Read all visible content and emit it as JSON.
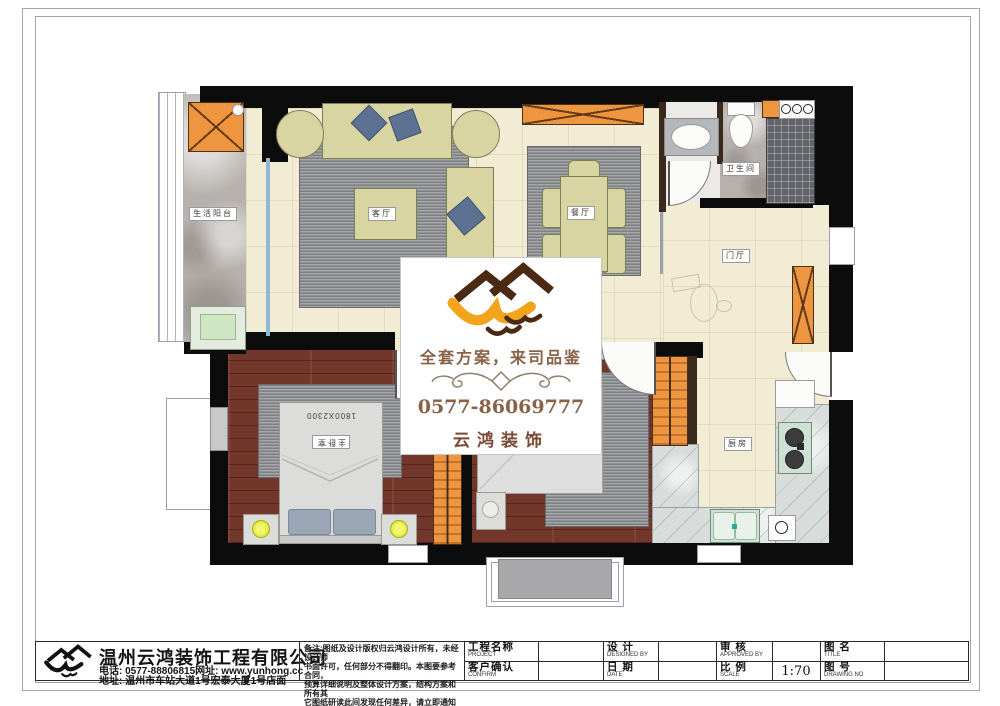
{
  "plan": {
    "labels": {
      "balcony": "生活阳台",
      "living": "客厅",
      "dining": "餐厅",
      "bathroom": "卫生间",
      "hall": "门厅",
      "master": "主卧室",
      "master_bed_size": "1800X2300",
      "kitchen": "厨房"
    }
  },
  "watermark": {
    "slogan": "全套方案，来司品鉴",
    "phone": "0577-86069777",
    "brand": "云鸿装饰"
  },
  "titleblock": {
    "company": "温州云鸿装饰工程有限公司",
    "phone_line": "电话: 0577-88806815网址: www.yunhong.cc",
    "address_line": "地址: 温州市车站大道1号宏泰大厦1号店面",
    "notes": [
      "备注:图纸及设计版权归云鸿设计所有，未经设计师",
      "书面许可，任何部分不得翻印。本图要参考合同，",
      "预算详细说明及整体设计方案，结构方案和所有其",
      "它图纸研读此间发现任何差异，请立即通知设计师。"
    ],
    "fields": {
      "project": {
        "cn": "工程名称",
        "en": "PROJECT",
        "value": ""
      },
      "designed": {
        "cn": "设 计",
        "en": "DESIGNED BY",
        "value": ""
      },
      "approved": {
        "cn": "审 核",
        "en": "APPROVED BY",
        "value": ""
      },
      "title": {
        "cn": "图 名",
        "en": "TITLE",
        "value": ""
      },
      "confirm": {
        "cn": "客户确认",
        "en": "CONFIRM",
        "value": ""
      },
      "date": {
        "cn": "日 期",
        "en": "DATE",
        "value": ""
      },
      "scale": {
        "cn": "比 例",
        "en": "SCALE",
        "value": "1:70"
      },
      "drawing_no": {
        "cn": "图 号",
        "en": "DRAWING NO",
        "value": ""
      }
    }
  },
  "colors": {
    "wall": "#0c0c0c",
    "accent_orange": "#ee9540",
    "wood_floor": "#73362a",
    "rug_gray": "#8f9194",
    "furniture_khaki": "#d8d5a2",
    "pillow_blue": "#5d7292",
    "brand_brown": "#8a6248",
    "lamp_yellow": "#e8ef4a"
  }
}
